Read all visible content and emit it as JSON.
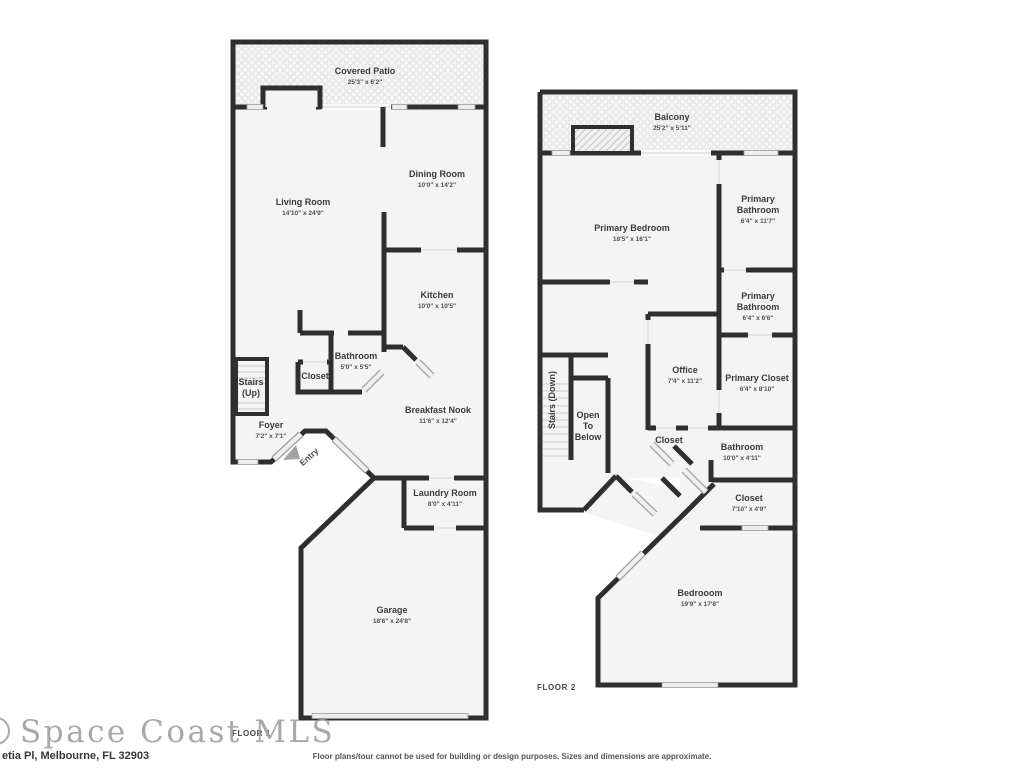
{
  "colors": {
    "wall": "#2f2f2f",
    "floor": "#f4f4f4",
    "window": "#ededed",
    "label": "#3b3b3b"
  },
  "floor1": {
    "label": "FLOOR 1",
    "rooms": {
      "covered_patio": {
        "name": "Covered Patio",
        "dims": "25'3\" x 6'2\""
      },
      "living_room": {
        "name": "Living Room",
        "dims": "14'10\" x 24'9\""
      },
      "dining_room": {
        "name": "Dining Room",
        "dims": "10'0\" x 14'2\""
      },
      "kitchen": {
        "name": "Kitchen",
        "dims": "10'0\" x 10'5\""
      },
      "bathroom": {
        "name": "Bathroom",
        "dims": "5'0\" x 5'5\""
      },
      "closet": {
        "name": "Closet"
      },
      "stairs": {
        "name1": "Stairs",
        "name2": "(Up)"
      },
      "foyer": {
        "name": "Foyer",
        "dims": "7'2\" x 7'1\""
      },
      "entry": {
        "name": "Entry"
      },
      "breakfast_nook": {
        "name": "Breakfast Nook",
        "dims": "11'6\" x 12'4\""
      },
      "laundry_room": {
        "name": "Laundry Room",
        "dims": "8'0\" x 4'11\""
      },
      "garage": {
        "name": "Garage",
        "dims": "18'6\" x 24'8\""
      }
    }
  },
  "floor2": {
    "label": "FLOOR 2",
    "rooms": {
      "balcony": {
        "name": "Balcony",
        "dims": "25'2\" x 5'11\""
      },
      "primary_bedroom": {
        "name": "Primary Bedroom",
        "dims": "18'5\" x 16'1\""
      },
      "primary_bathroom_1": {
        "name1": "Primary",
        "name2": "Bathroom",
        "dims": "6'4\" x 11'7\""
      },
      "primary_bathroom_2": {
        "name1": "Primary",
        "name2": "Bathroom",
        "dims": "6'4\" x 6'6\""
      },
      "office": {
        "name": "Office",
        "dims": "7'4\" x 11'2\""
      },
      "primary_closet": {
        "name": "Primary Closet",
        "dims": "6'4\" x 8'10\""
      },
      "stairs": {
        "name": "Stairs (Down)"
      },
      "open_to_below": {
        "name1": "Open",
        "name2": "To",
        "name3": "Below"
      },
      "closet_a": {
        "name": "Closet"
      },
      "bathroom": {
        "name": "Bathroom",
        "dims": "10'0\" x 4'11\""
      },
      "closet_b": {
        "name": "Closet",
        "dims": "7'10\" x 4'9\""
      },
      "bedroom": {
        "name": "Bedrooom",
        "dims": "19'9\" x 17'8\""
      }
    }
  },
  "footer": {
    "logo": "Space Coast MLS",
    "address": "etia Pl, Melbourne, FL 32903",
    "disclaimer": "Floor plans/tour cannot be used for building or design purposes. Sizes and dimensions are approximate."
  }
}
